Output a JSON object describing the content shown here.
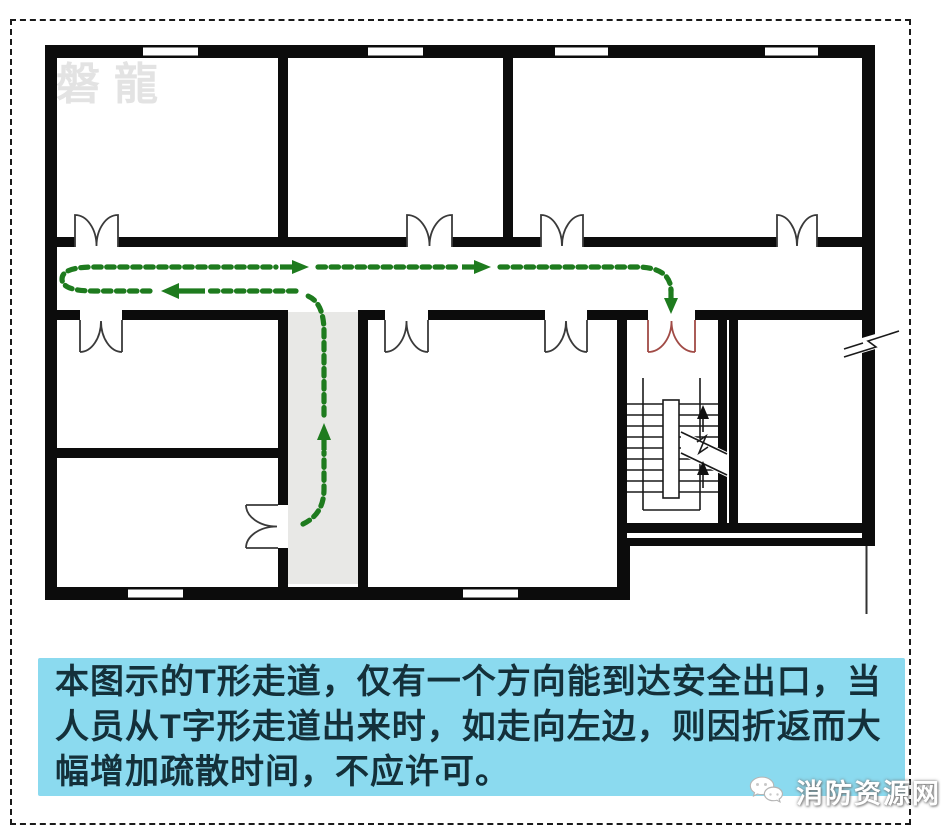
{
  "watermarks": {
    "top_left": "磐龍",
    "bottom_right": {
      "icon": "wechat-icon",
      "label": "消防资源网"
    }
  },
  "caption": {
    "lines": [
      "本图示的T形走道，仅有一个方向能到达安全出口，当",
      "人员从T字形走道出来时，如走向左边，则因折返而大",
      "幅增加疏散时间，不应许可。"
    ]
  },
  "icons": {
    "bottom_watermark": "wechat-icon",
    "room_doors": "double-swing-door-icon",
    "stair_exit_door": "exit-door-icon",
    "route_arrows": [
      "arrow-right-icon",
      "arrow-left-icon",
      "arrow-up-icon",
      "arrow-down-icon"
    ],
    "stair_direction": "stair-up-arrow-icon",
    "wall_break": "wall-break-icon"
  },
  "colors": {
    "wall": "#0c0c0c",
    "route_green": "#1e7b1e",
    "exit_door_red": "#a14b46",
    "corridor_fill": "#e8e8e6",
    "caption_bg": "#8bdaef",
    "caption_text": "#14303a",
    "watermark_gray": "#e3e3e3",
    "border": "#1a1a1a"
  }
}
